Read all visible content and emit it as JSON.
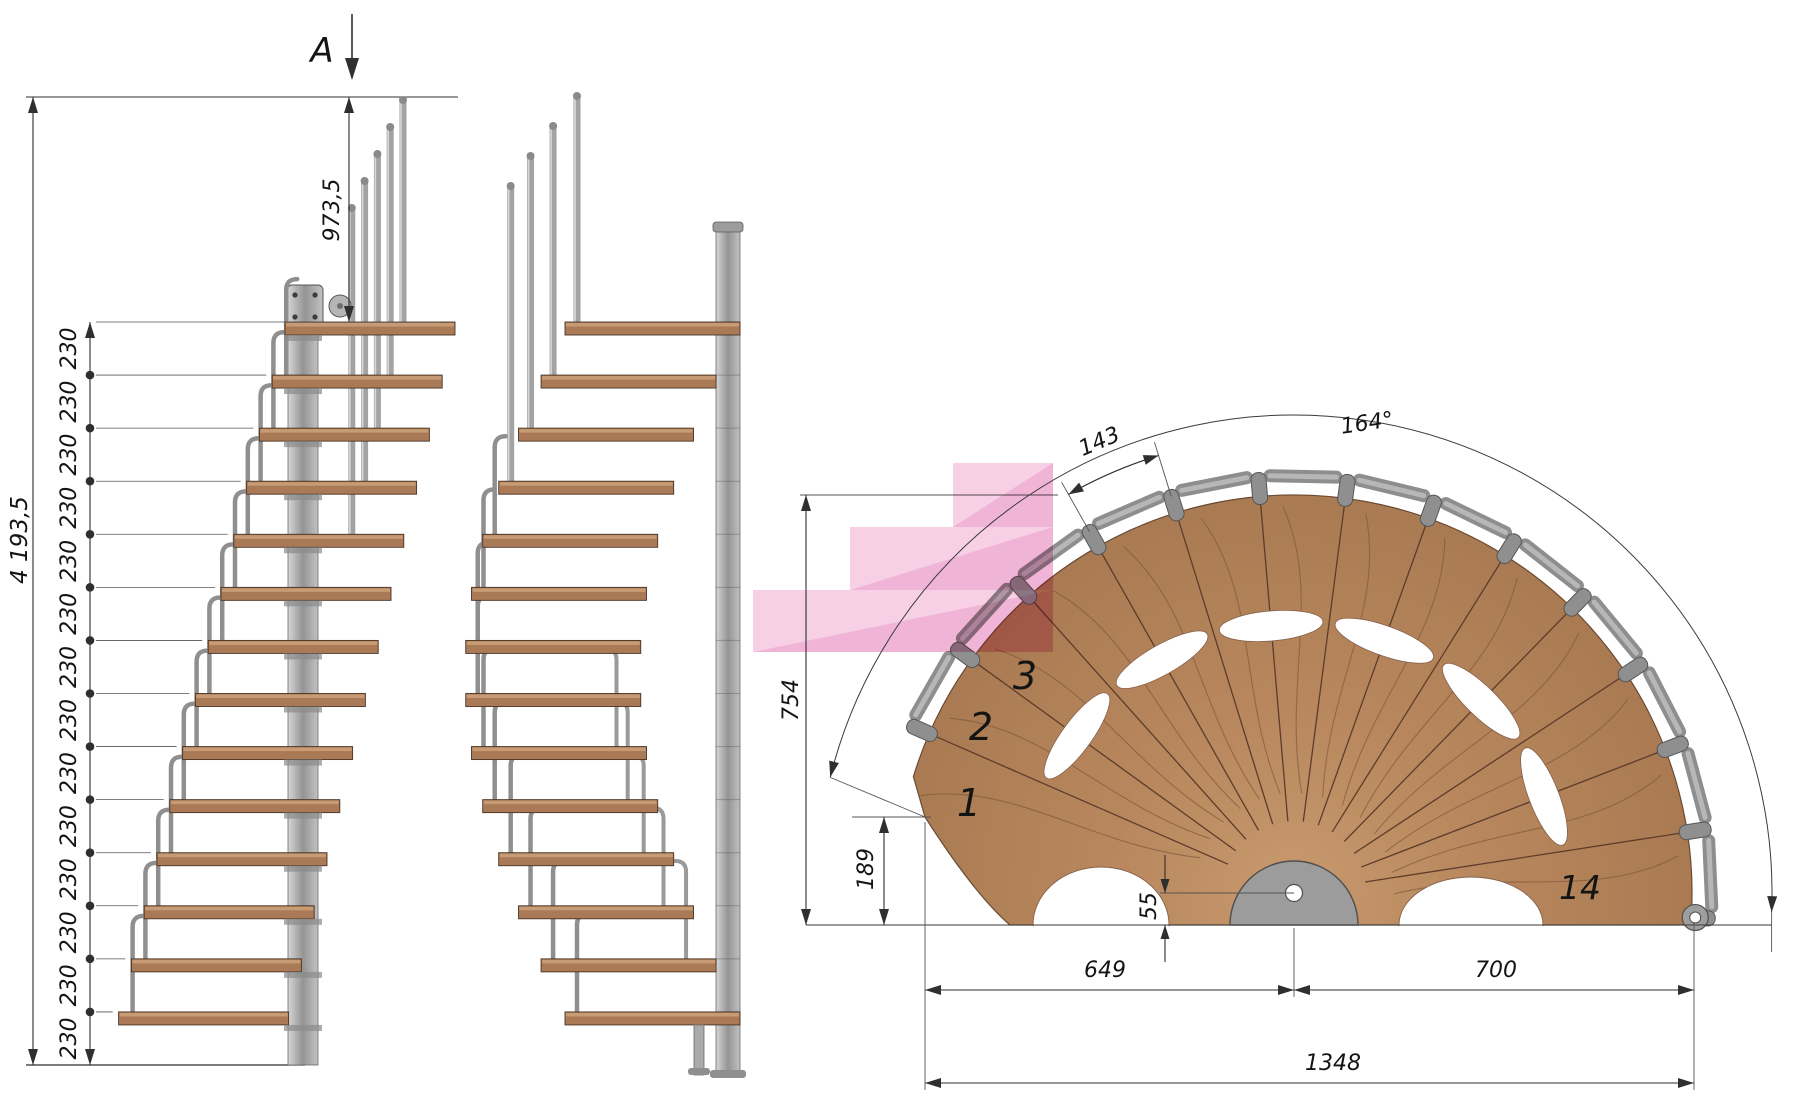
{
  "colors": {
    "line": "#2f2f2f",
    "thin": "#555555",
    "wood_side": "#aa7a57",
    "wood_top": "#c79c74",
    "wood_plan_in": "#c89a6e",
    "wood_plan_mid": "#b8875d",
    "wood_plan_out": "#a97a52",
    "wood_dark": "#5c3d2b",
    "wood_grain": "#7d563c",
    "metal": "#b3b3b3",
    "metal_mid": "#9a9a9a",
    "metal_dark": "#6e6e6e",
    "rail": "#8e8e8e",
    "rail_hi": "#b7b7b7",
    "pink": "#f0a5d0",
    "pink_dark": "#e27cb4"
  },
  "section_marker": {
    "label": "A"
  },
  "elevation": {
    "total_height": "4 193,5",
    "top_flight_height": "973,5",
    "riser_height": "230",
    "riser_count": 14
  },
  "plan": {
    "going": "143",
    "rotation_angle": "164°",
    "outer_height": "754",
    "entry_height": "189",
    "hub_height": "55",
    "left_run": "649",
    "right_run": "700",
    "total_run": "1348",
    "step_numbers": [
      "1",
      "2",
      "3",
      "14"
    ]
  }
}
